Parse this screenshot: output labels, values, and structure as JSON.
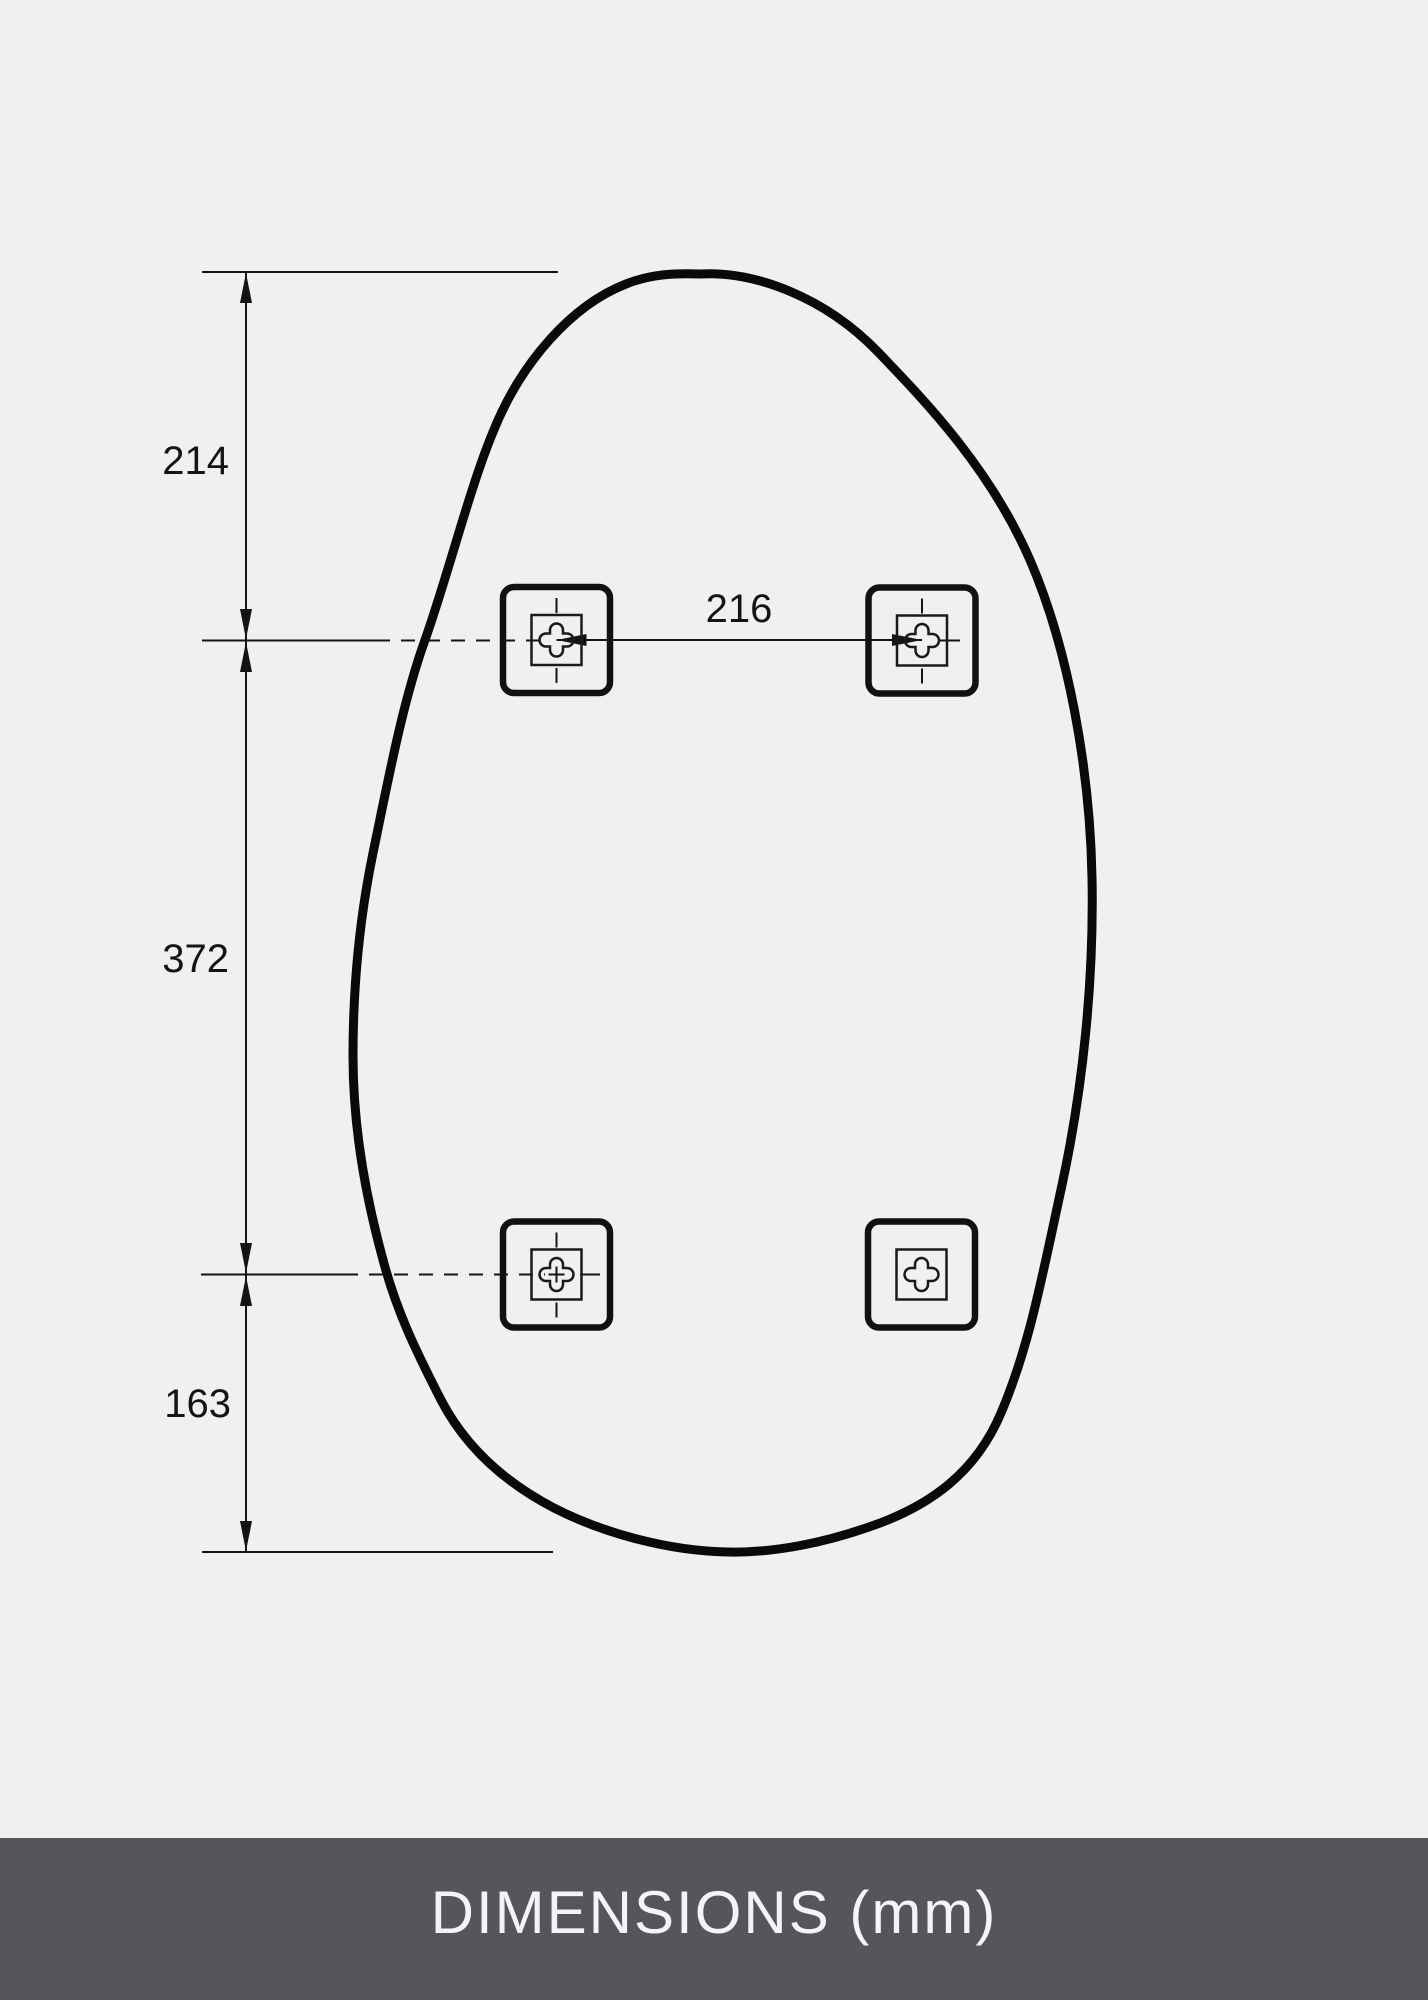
{
  "diagram": {
    "title": "mirror-mounting-dimension-drawing",
    "unit_label": "DIMENSIONS (mm)",
    "dimensions": {
      "top_edge_to_upper_brackets": "214",
      "upper_to_lower_brackets": "372",
      "lower_brackets_to_bottom_edge": "163",
      "bracket_horizontal_spacing": "216"
    },
    "colors": {
      "background": "#F0F0F1",
      "line": "#141414",
      "outline": "#0A0A0A",
      "footer_background": "#55565A",
      "footer_text": "#F4F4F6"
    }
  }
}
